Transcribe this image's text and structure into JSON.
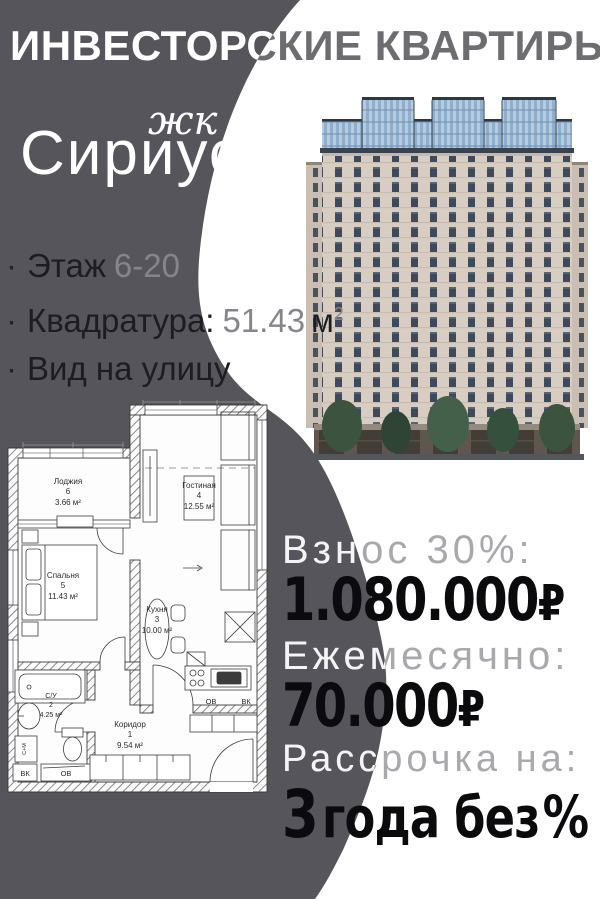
{
  "header": {
    "title": "ИНВЕСТОРСКИЕ КВАРТИРЫ"
  },
  "brand": {
    "complex_type": "жк",
    "name": "Сириус"
  },
  "features": {
    "bullet": "·",
    "items": [
      {
        "label": "Этаж",
        "value": "6-20",
        "unit": "",
        "unit_sup": ""
      },
      {
        "label": "Квадратура:",
        "value": "51.43",
        "unit": "м",
        "unit_sup": "2"
      },
      {
        "label": "Вид на улицу",
        "value": "",
        "unit": "",
        "unit_sup": ""
      }
    ]
  },
  "pricing": {
    "down_payment": {
      "label": "Взнос 30%:",
      "amount": "1.080.000",
      "currency": "₽"
    },
    "monthly": {
      "label": "Ежемесячно:",
      "amount": "70.000",
      "currency": "₽"
    },
    "installment": {
      "label": "Рассрочка на:",
      "number": "3",
      "words": "года без",
      "percent": "%"
    }
  },
  "floor_plan": {
    "rooms": [
      {
        "name": "Лоджия",
        "number": "6",
        "area": "3.66 м²"
      },
      {
        "name": "Гостиная",
        "number": "4",
        "area": "12.55 м²"
      },
      {
        "name": "Спальня",
        "number": "5",
        "area": "11.43 м²"
      },
      {
        "name": "Кухня",
        "number": "3",
        "area": "10.00 м²"
      },
      {
        "name": "С/У",
        "number": "2",
        "area": "4.25 м²"
      },
      {
        "name": "Коридор",
        "number": "1",
        "area": "9.54 м²"
      }
    ],
    "labels": {
      "ov": "ОВ",
      "vk": "ВК",
      "sm": "С+М"
    }
  },
  "colors": {
    "background_dark": "#55555b",
    "text_dark": "#0b0b0d",
    "title_gray": "#6d6d71"
  }
}
